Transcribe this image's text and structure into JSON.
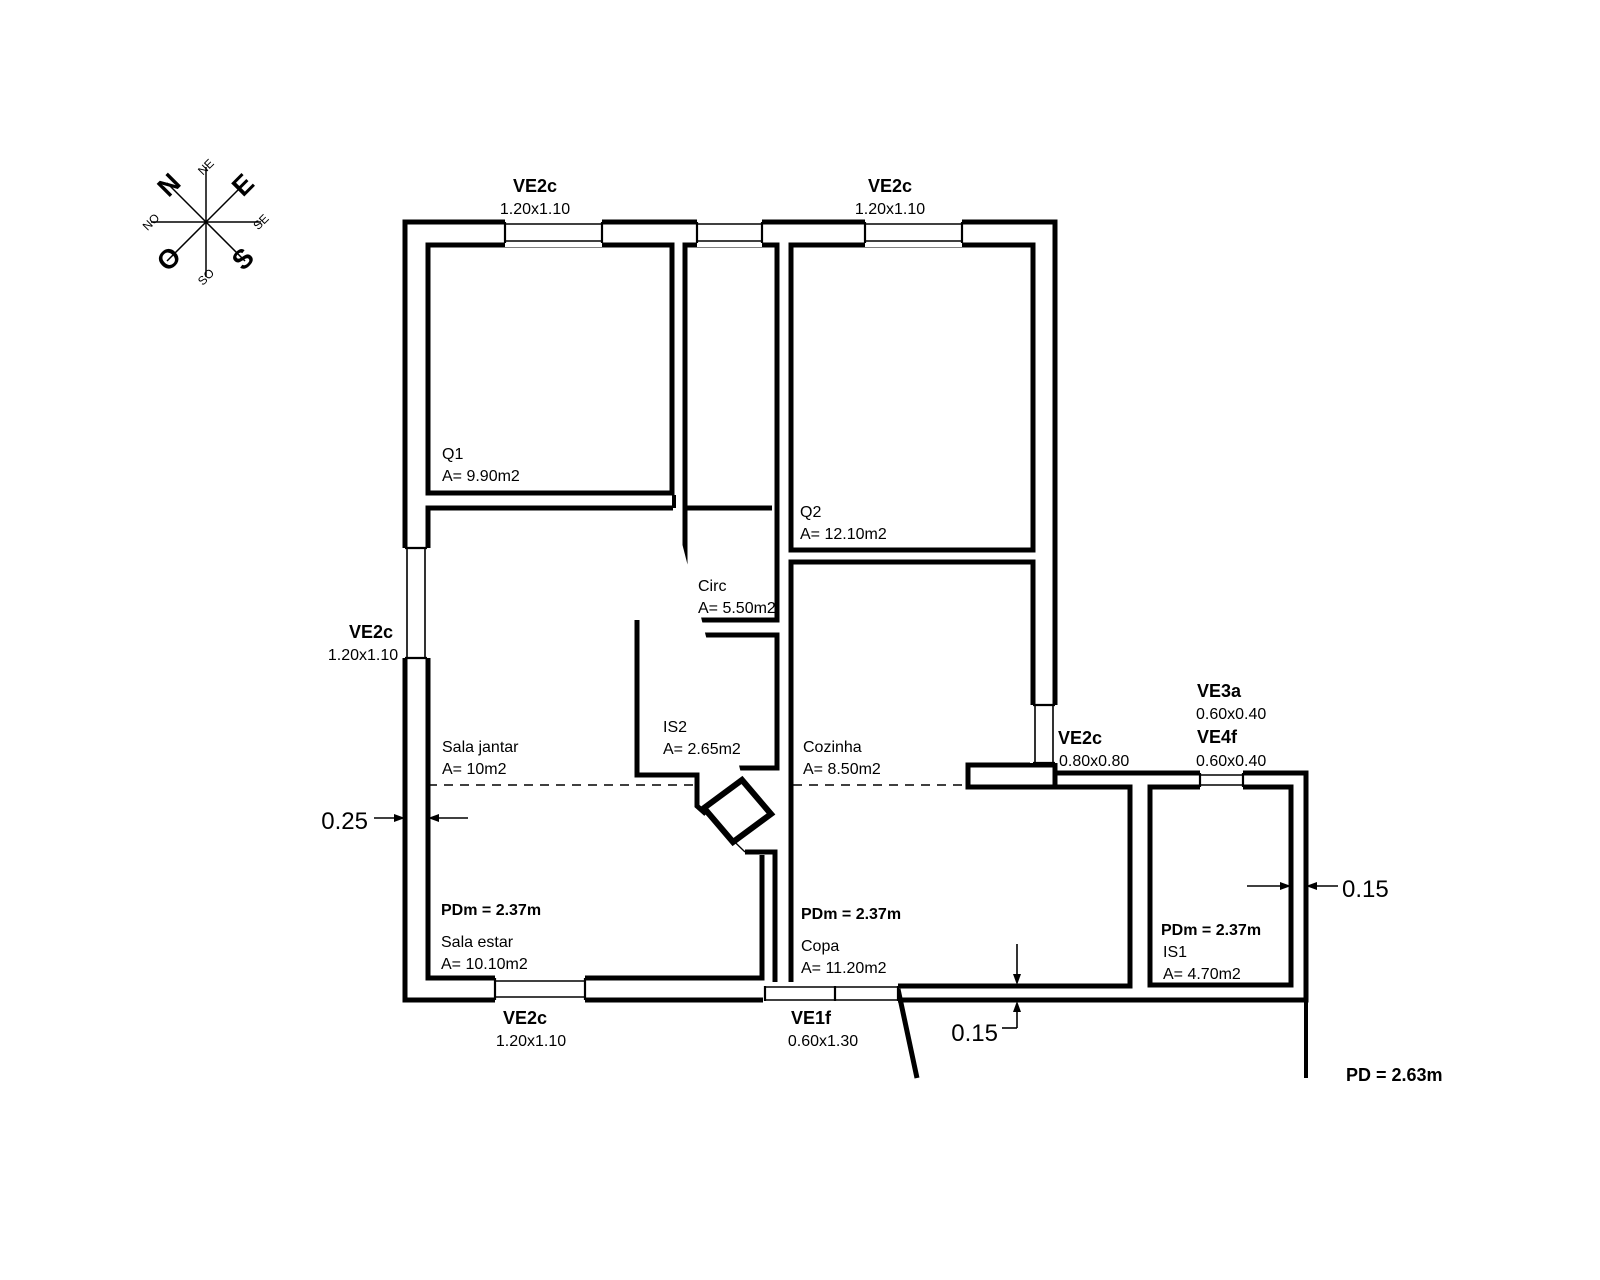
{
  "drawing": {
    "type": "architectural floor plan",
    "dim_color": "#c63434",
    "wall_color": "#000000",
    "ceiling_note": "PD = 2.63m"
  },
  "compass": {
    "center": {
      "x": 206,
      "y": 222
    },
    "cardinals": [
      {
        "label": "N",
        "x": 169,
        "y": 185,
        "big": true
      },
      {
        "label": "E",
        "x": 243,
        "y": 185,
        "big": true
      },
      {
        "label": "S",
        "x": 243,
        "y": 259,
        "big": true
      },
      {
        "label": "O",
        "x": 169,
        "y": 259,
        "big": true
      }
    ],
    "intercardinals": [
      {
        "label": "NE",
        "x": 206,
        "y": 167,
        "big": false
      },
      {
        "label": "SE",
        "x": 261,
        "y": 222,
        "big": false
      },
      {
        "label": "SO",
        "x": 206,
        "y": 277,
        "big": false
      },
      {
        "label": "NO",
        "x": 151,
        "y": 222,
        "big": false
      }
    ]
  },
  "rooms": [
    {
      "name": "Q1",
      "area": "A= 9.90m2"
    },
    {
      "name": "Q2",
      "area": "A= 12.10m2"
    },
    {
      "name": "Circ",
      "area": "A= 5.50m2"
    },
    {
      "name": "IS2",
      "area": "A= 2.65m2"
    },
    {
      "name": "Cozinha",
      "area": "A= 8.50m2"
    },
    {
      "name": "Sala jantar",
      "area": "A= 10m2"
    },
    {
      "name": "Sala estar",
      "area": "A= 10.10m2",
      "ceiling": "PDm = 2.37m"
    },
    {
      "name": "Copa",
      "area": "A= 11.20m2",
      "ceiling": "PDm = 2.37m"
    },
    {
      "name": "IS1",
      "area": "A= 4.70m2",
      "ceiling": "PDm = 2.37m"
    }
  ],
  "windows": [
    {
      "tag": "VE2c",
      "size": "1.20x1.10",
      "position": "north wall west"
    },
    {
      "tag": "VE2c",
      "size": "1.20x1.10",
      "position": "north wall east"
    },
    {
      "tag": "VE2c",
      "size": "1.20x1.10",
      "position": "west wall"
    },
    {
      "tag": "VE2c",
      "size": "1.20x1.10",
      "position": "south wall"
    },
    {
      "tag": "VE1f",
      "size": "0.60x1.30",
      "position": "south wall copa"
    },
    {
      "tag": "VE2c",
      "size": "0.80x0.80",
      "position": "east wall cozinha"
    },
    {
      "tag": "VE3a",
      "size": "0.60x0.40",
      "position": "north wall is1"
    },
    {
      "tag": "VE4f",
      "size": "0.60x0.40",
      "position": "north wall is1"
    }
  ],
  "dimensions": [
    {
      "value": "0.25",
      "measures": "west exterior wall thickness"
    },
    {
      "value": "0.15",
      "measures": "east exterior wall thickness"
    },
    {
      "value": "0.15",
      "measures": "south copa wall thickness"
    }
  ],
  "labels": [
    {
      "id": "ve2c-topleft-tag",
      "text": "VE2c",
      "x": 535,
      "y": 192,
      "cls": "tag",
      "anchor": "middle"
    },
    {
      "id": "ve2c-topleft-size",
      "text": "1.20x1.10",
      "x": 535,
      "y": 214,
      "cls": "size",
      "anchor": "middle"
    },
    {
      "id": "ve2c-topright-tag",
      "text": "VE2c",
      "x": 890,
      "y": 192,
      "cls": "tag",
      "anchor": "middle"
    },
    {
      "id": "ve2c-topright-size",
      "text": "1.20x1.10",
      "x": 890,
      "y": 214,
      "cls": "size",
      "anchor": "middle"
    },
    {
      "id": "ve2c-left-tag",
      "text": "VE2c",
      "x": 371,
      "y": 638,
      "cls": "tag",
      "anchor": "middle"
    },
    {
      "id": "ve2c-left-size",
      "text": "1.20x1.10",
      "x": 363,
      "y": 660,
      "cls": "size",
      "anchor": "middle"
    },
    {
      "id": "ve2c-bottom-tag",
      "text": "VE2c",
      "x": 525,
      "y": 1024,
      "cls": "tag",
      "anchor": "middle"
    },
    {
      "id": "ve2c-bottom-size",
      "text": "1.20x1.10",
      "x": 531,
      "y": 1046,
      "cls": "size",
      "anchor": "middle"
    },
    {
      "id": "ve1f-tag",
      "text": "VE1f",
      "x": 811,
      "y": 1024,
      "cls": "tag",
      "anchor": "middle"
    },
    {
      "id": "ve1f-size",
      "text": "0.60x1.30",
      "x": 823,
      "y": 1046,
      "cls": "size",
      "anchor": "middle"
    },
    {
      "id": "ve2c-east-tag",
      "text": "VE2c",
      "x": 1058,
      "y": 744,
      "cls": "tag",
      "anchor": "start"
    },
    {
      "id": "ve2c-east-size",
      "text": "0.80x0.80",
      "x": 1059,
      "y": 766,
      "cls": "size",
      "anchor": "start"
    },
    {
      "id": "ve3a-tag",
      "text": "VE3a",
      "x": 1197,
      "y": 697,
      "cls": "tag",
      "anchor": "start"
    },
    {
      "id": "ve3a-size",
      "text": "0.60x0.40",
      "x": 1196,
      "y": 719,
      "cls": "size",
      "anchor": "start"
    },
    {
      "id": "ve4f-tag",
      "text": "VE4f",
      "x": 1197,
      "y": 743,
      "cls": "tag",
      "anchor": "start"
    },
    {
      "id": "ve4f-size",
      "text": "0.60x0.40",
      "x": 1196,
      "y": 766,
      "cls": "size",
      "anchor": "start"
    },
    {
      "id": "room-q1",
      "text": "Q1",
      "x": 442,
      "y": 459,
      "cls": "room",
      "anchor": "start"
    },
    {
      "id": "room-q1-area",
      "text": "A= 9.90m2",
      "x": 442,
      "y": 481,
      "cls": "room",
      "anchor": "start"
    },
    {
      "id": "room-q2",
      "text": "Q2",
      "x": 800,
      "y": 517,
      "cls": "room",
      "anchor": "start"
    },
    {
      "id": "room-q2-area",
      "text": "A= 12.10m2",
      "x": 800,
      "y": 539,
      "cls": "room",
      "anchor": "start"
    },
    {
      "id": "room-circ",
      "text": "Circ",
      "x": 698,
      "y": 591,
      "cls": "room",
      "anchor": "start"
    },
    {
      "id": "room-circ-area",
      "text": "A= 5.50m2",
      "x": 698,
      "y": 613,
      "cls": "room",
      "anchor": "start"
    },
    {
      "id": "room-is2",
      "text": "IS2",
      "x": 663,
      "y": 732,
      "cls": "room",
      "anchor": "start"
    },
    {
      "id": "room-is2-area",
      "text": "A= 2.65m2",
      "x": 663,
      "y": 754,
      "cls": "room",
      "anchor": "start"
    },
    {
      "id": "room-cozinha",
      "text": "Cozinha",
      "x": 803,
      "y": 752,
      "cls": "room",
      "anchor": "start"
    },
    {
      "id": "room-cozinha-area",
      "text": "A= 8.50m2",
      "x": 803,
      "y": 774,
      "cls": "room",
      "anchor": "start"
    },
    {
      "id": "room-salajantar",
      "text": "Sala jantar",
      "x": 442,
      "y": 752,
      "cls": "room",
      "anchor": "start"
    },
    {
      "id": "room-salajantar-area",
      "text": "A= 10m2",
      "x": 442,
      "y": 774,
      "cls": "room",
      "anchor": "start"
    },
    {
      "id": "pdm-salaestar",
      "text": "PDm = 2.37m",
      "x": 441,
      "y": 915,
      "cls": "pdm",
      "anchor": "start"
    },
    {
      "id": "room-salaestar",
      "text": "Sala estar",
      "x": 441,
      "y": 947,
      "cls": "room",
      "anchor": "start"
    },
    {
      "id": "room-salaestar-area",
      "text": "A= 10.10m2",
      "x": 441,
      "y": 969,
      "cls": "room",
      "anchor": "start"
    },
    {
      "id": "pdm-copa",
      "text": "PDm = 2.37m",
      "x": 801,
      "y": 919,
      "cls": "pdm",
      "anchor": "start"
    },
    {
      "id": "room-copa",
      "text": "Copa",
      "x": 801,
      "y": 951,
      "cls": "room",
      "anchor": "start"
    },
    {
      "id": "room-copa-area",
      "text": "A= 11.20m2",
      "x": 801,
      "y": 973,
      "cls": "room",
      "anchor": "start"
    },
    {
      "id": "pdm-is1",
      "text": "PDm = 2.37m",
      "x": 1161,
      "y": 935,
      "cls": "pdm",
      "anchor": "start"
    },
    {
      "id": "room-is1",
      "text": "IS1",
      "x": 1163,
      "y": 957,
      "cls": "room",
      "anchor": "start"
    },
    {
      "id": "room-is1-area",
      "text": "A= 4.70m2",
      "x": 1163,
      "y": 979,
      "cls": "room",
      "anchor": "start"
    },
    {
      "id": "pd-note",
      "text": "PD = 2.63m",
      "x": 1346,
      "y": 1081,
      "cls": "pd",
      "anchor": "start"
    },
    {
      "id": "dim-west-wall",
      "text": "0.25",
      "x": 368,
      "y": 829,
      "cls": "dim",
      "anchor": "end",
      "color": "#c63434"
    },
    {
      "id": "dim-east-wall",
      "text": "0.15",
      "x": 1342,
      "y": 897,
      "cls": "dim",
      "anchor": "start",
      "color": "#c63434"
    },
    {
      "id": "dim-south-wall",
      "text": "0.15",
      "x": 998,
      "y": 1041,
      "cls": "dim",
      "anchor": "end",
      "color": "#c63434"
    }
  ]
}
